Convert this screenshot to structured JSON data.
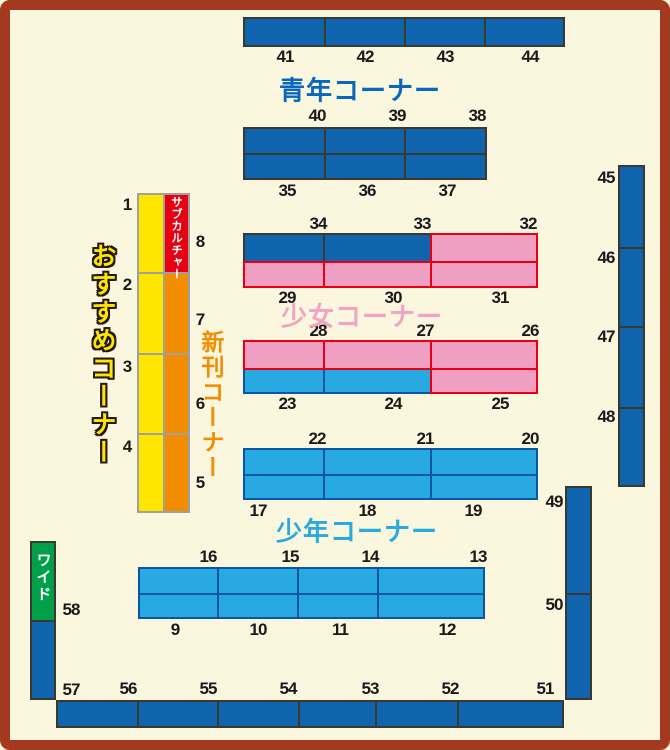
{
  "map": {
    "corner_labels": {
      "seinen": "青年コーナー",
      "shojo": "少女コーナー",
      "shonen": "少年コーナー",
      "new_releases": "新刊コーナー",
      "recommended": "おすすめコーナー",
      "subculture": "サブカルチャー",
      "wide": "ワイド"
    },
    "shelves": {
      "top_row": [
        "41",
        "42",
        "43",
        "44"
      ],
      "seinen_upper": [
        "40",
        "39",
        "38"
      ],
      "seinen_lower": [
        "35",
        "36",
        "37"
      ],
      "shojo_a_upper": [
        "34",
        "33",
        "32"
      ],
      "shojo_a_lower": [
        "29",
        "30",
        "31"
      ],
      "shojo_b_upper": [
        "28",
        "27",
        "26"
      ],
      "shojo_b_lower": [
        "23",
        "24",
        "25"
      ],
      "shonen_a_upper": [
        "22",
        "21",
        "20"
      ],
      "shonen_a_lower": [
        "17",
        "18",
        "19"
      ],
      "shonen_b_upper": [
        "16",
        "15",
        "14",
        "13"
      ],
      "shonen_b_lower": [
        "9",
        "10",
        "11",
        "12"
      ],
      "recommended_col": [
        "1",
        "2",
        "3",
        "4"
      ],
      "new_col": [
        "8",
        "7",
        "6",
        "5"
      ],
      "right_upper": [
        "45",
        "46",
        "47",
        "48"
      ],
      "right_lower": [
        "49",
        "50"
      ],
      "left_lower": [
        "58",
        "57"
      ],
      "bottom_row": [
        "56",
        "55",
        "54",
        "53",
        "52",
        "51"
      ]
    },
    "colors": {
      "background": "#FBF7DF",
      "frame": "#A33A20",
      "dark_blue": "#1063AD",
      "light_blue": "#29A9E2",
      "pink": "#F09EC2",
      "pink_border": "#E60012",
      "yellow": "#FFE600",
      "orange": "#F28C00",
      "red": "#E60012",
      "green": "#00A04B"
    }
  }
}
